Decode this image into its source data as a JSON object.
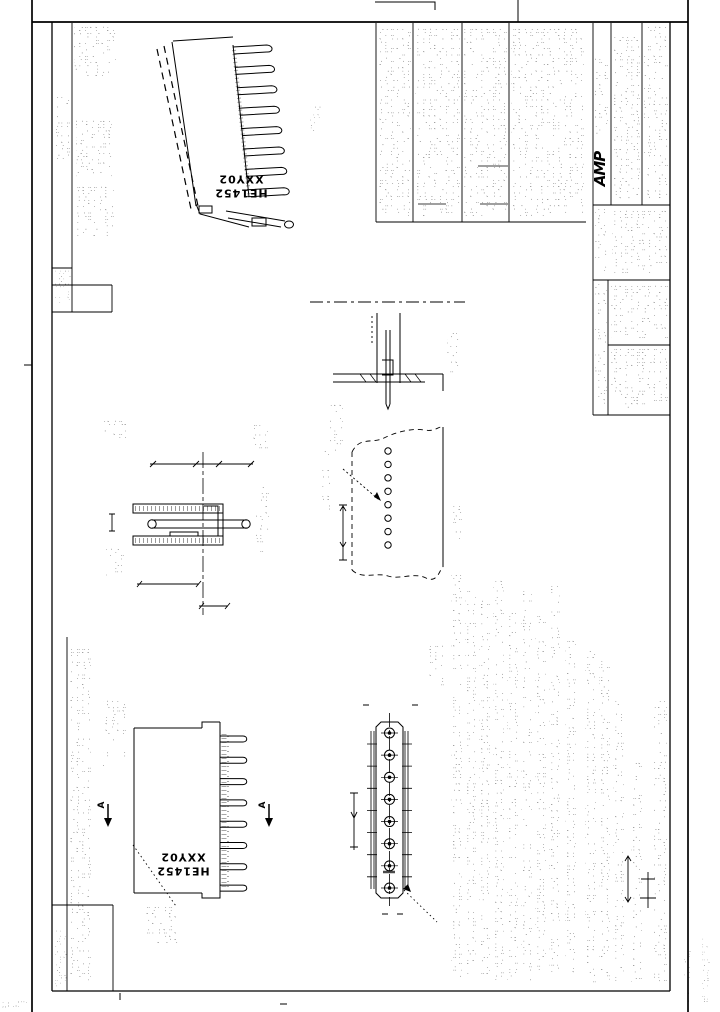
{
  "sheet": {
    "part_marking": {
      "line1": "HE1452",
      "line2": "XXY02"
    },
    "logo_text": "AMP",
    "section_label": "A",
    "ink_color": "#000000",
    "paper_color": "#ffffff"
  }
}
